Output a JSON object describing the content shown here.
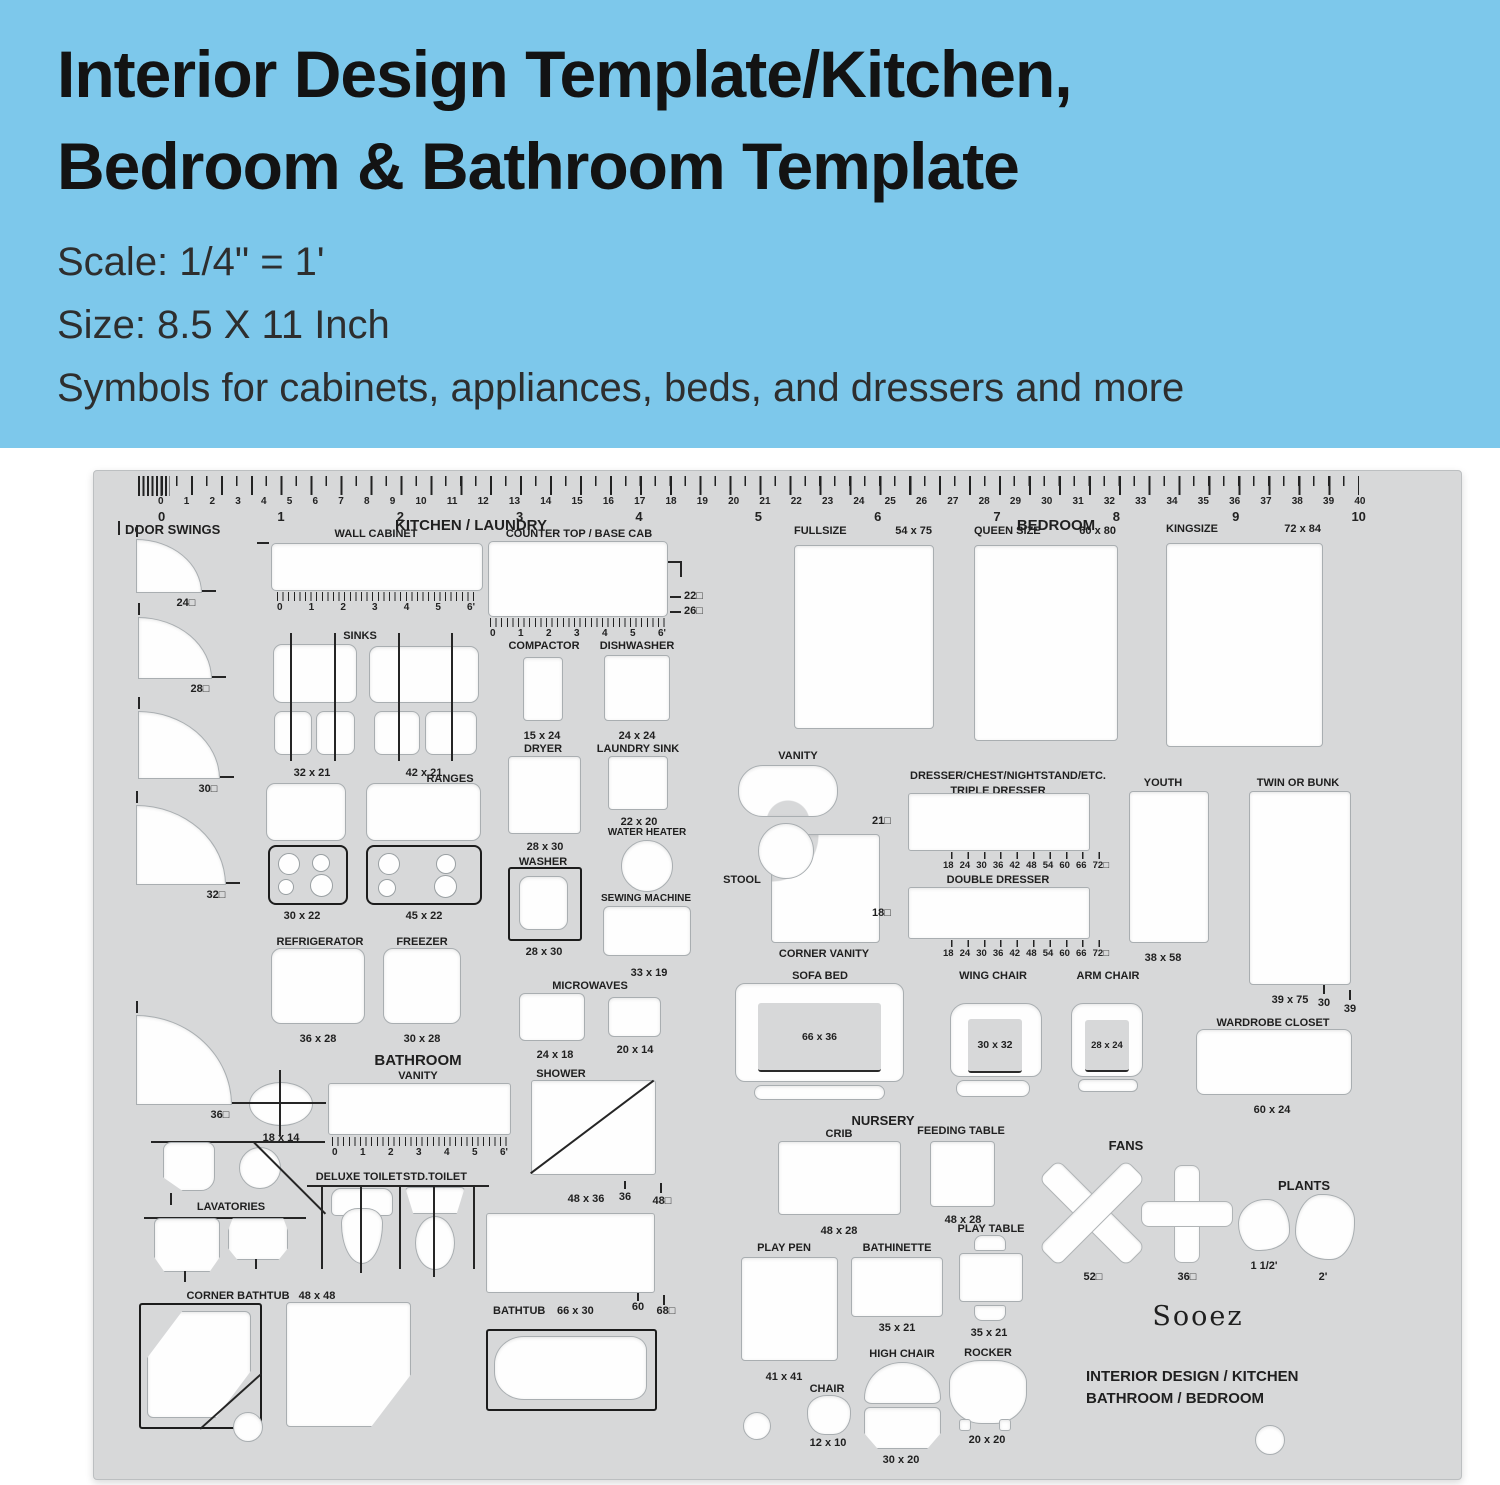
{
  "banner": {
    "title_line1": "Interior Design Template/Kitchen,",
    "title_line2": "Bedroom & Bathroom Template",
    "scale": "Scale: 1/4\" = 1'",
    "size": "Size: 8.5 X 11 Inch",
    "tagline": "Symbols for cabinets, appliances, beds, and dressers and more"
  },
  "colors": {
    "banner_bg": "#7dc8eb",
    "sheet": "#d7d8d9",
    "cutout": "#fefefe",
    "ink": "#222222"
  },
  "ruler": {
    "minor": [
      "0",
      "1",
      "2",
      "3",
      "4",
      "5",
      "6",
      "7",
      "8",
      "9",
      "10",
      "11",
      "12",
      "13",
      "14",
      "15",
      "16",
      "17",
      "18",
      "19",
      "20",
      "21",
      "22",
      "23",
      "24",
      "25",
      "26",
      "27",
      "28",
      "29",
      "30",
      "31",
      "32",
      "33",
      "34",
      "35",
      "36",
      "37",
      "38",
      "39",
      "40"
    ],
    "major": [
      "0",
      "1",
      "2",
      "3",
      "4",
      "5",
      "6",
      "7",
      "8",
      "9",
      "10"
    ],
    "cabinet": [
      "0",
      "1",
      "2",
      "3",
      "4",
      "5",
      "6'"
    ],
    "dresser": [
      "18",
      "24",
      "30",
      "36",
      "42",
      "48",
      "54",
      "60",
      "66",
      "72□"
    ]
  },
  "kitchen": {
    "header": "KITCHEN / LAUNDRY",
    "door_swings": {
      "label": "DOOR SWINGS",
      "sizes": [
        "24□",
        "28□",
        "30□",
        "32□",
        "36□"
      ]
    },
    "wall_cabinet": {
      "label": "WALL CABINET"
    },
    "counter_top": {
      "label": "COUNTER TOP / BASE CAB",
      "d1": "22□",
      "d2": "26□"
    },
    "sinks": {
      "label": "SINKS",
      "dim1": "32 x 21",
      "dim2": "42 x 21"
    },
    "ranges": {
      "label": "RANGES",
      "dim1": "30 x 22",
      "dim2": "45 x 22"
    },
    "refrigerator": {
      "label": "REFRIGERATOR",
      "dim": "36 x 28"
    },
    "freezer": {
      "label": "FREEZER",
      "dim": "30 x 28"
    },
    "compactor": {
      "label": "COMPACTOR",
      "dim": "15 x 24"
    },
    "dishwasher": {
      "label": "DISHWASHER",
      "dim": "24 x 24"
    },
    "dryer": {
      "label": "DRYER",
      "dim": "28 x 30"
    },
    "laundry_sink": {
      "label": "LAUNDRY SINK",
      "dim": "22 x 20"
    },
    "water_heater": {
      "label": "WATER HEATER"
    },
    "washer": {
      "label": "WASHER",
      "dim": "28 x 30"
    },
    "sewing_machine": {
      "label": "SEWING MACHINE",
      "dim": "33 x 19"
    },
    "microwaves": {
      "label": "MICROWAVES",
      "dim1": "24 x 18",
      "dim2": "20 x 14"
    }
  },
  "bathroom": {
    "header": "BATHROOM",
    "vanity": {
      "label": "VANITY"
    },
    "shower": {
      "label": "SHOWER",
      "dim": "48 x 36",
      "m1": "36",
      "m2": "48□",
      "m3": "60",
      "m4": "68□"
    },
    "deluxe_toilet": "DELUXE TOILET",
    "std_toilet": "STD.TOILET",
    "lavatories": {
      "label": "LAVATORIES",
      "dim": "18 x 14"
    },
    "corner_bathtub": {
      "label": "CORNER BATHTUB",
      "dim": "48 x 48"
    },
    "bathtub": {
      "label": "BATHTUB",
      "dim": "66 x 30"
    }
  },
  "bedroom": {
    "header": "BEDROOM",
    "fullsize": {
      "label": "FULLSIZE",
      "dim": "54 x 75"
    },
    "queen": {
      "label": "QUEEN SIZE",
      "dim": "60 x 80"
    },
    "king": {
      "label": "KINGSIZE",
      "dim": "72 x 84"
    },
    "vanity": {
      "label": "VANITY"
    },
    "stool": {
      "label": "STOOL"
    },
    "corner_vanity": {
      "label": "CORNER VANITY"
    },
    "dressers": {
      "header": "DRESSER/CHEST/NIGHTSTAND/ETC.",
      "triple": "TRIPLE DRESSER",
      "triple_depth": "21□",
      "double": "DOUBLE DRESSER",
      "double_depth": "18□"
    },
    "youth": {
      "label": "YOUTH",
      "dim": "38 x 58"
    },
    "twin": {
      "label": "TWIN OR BUNK",
      "dim": "39 x 75",
      "m1": "30",
      "m2": "39"
    },
    "sofa_bed": {
      "label": "SOFA BED",
      "dim": "66 x 36"
    },
    "wing_chair": {
      "label": "WING CHAIR",
      "dim": "30 x 32"
    },
    "arm_chair": {
      "label": "ARM CHAIR",
      "dim": "28 x 24"
    },
    "wardrobe": {
      "label": "WARDROBE CLOSET",
      "dim": "60 x 24"
    }
  },
  "nursery": {
    "header": "NURSERY",
    "crib": {
      "label": "CRIB",
      "dim": "48 x 28"
    },
    "feeding_table": {
      "label": "FEEDING TABLE",
      "dim": "48 x 28"
    },
    "play_table": {
      "label": "PLAY TABLE",
      "dim": "35 x 21"
    },
    "play_pen": {
      "label": "PLAY PEN",
      "dim": "41 x 41"
    },
    "bathinette": {
      "label": "BATHINETTE",
      "dim": "35 x 21"
    },
    "high_chair": {
      "label": "HIGH CHAIR",
      "dim": "30 x 20"
    },
    "rocker": {
      "label": "ROCKER",
      "dim": "20 x 20"
    },
    "chair": {
      "label": "CHAIR",
      "dim": "12 x 10"
    }
  },
  "misc": {
    "fans": {
      "label": "FANS",
      "dim1": "52□",
      "dim2": "36□"
    },
    "plants": {
      "label": "PLANTS",
      "dim1": "1 1/2'",
      "dim2": "2'"
    },
    "brand": "Sooez",
    "footer1": "INTERIOR DESIGN / KITCHEN",
    "footer2": "BATHROOM / BEDROOM"
  }
}
